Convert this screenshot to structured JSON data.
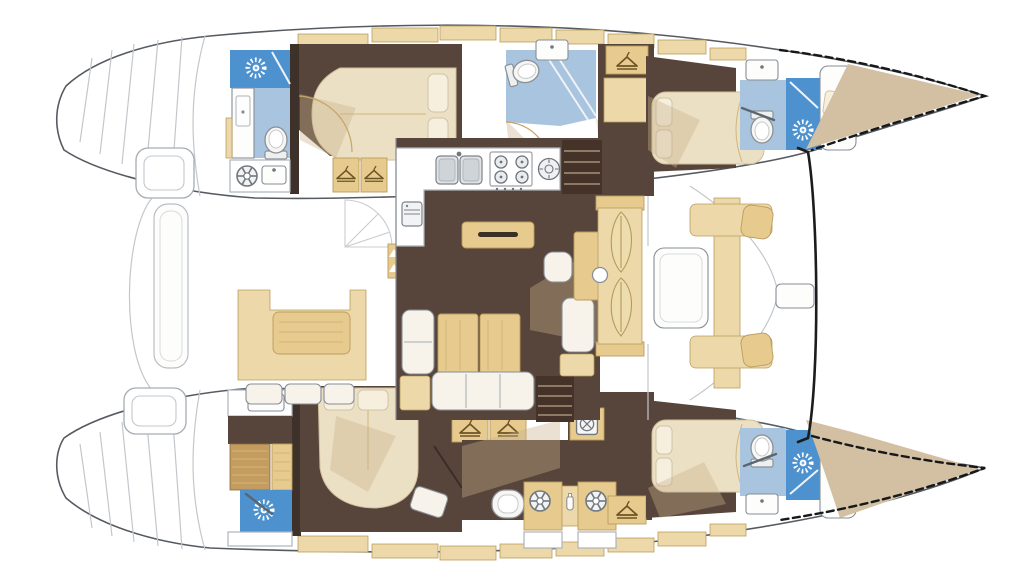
{
  "document": {
    "kind": "catamaran-yacht-interior-floor-plan",
    "view": "top-down deck plan, bow pointing right, stern at left",
    "visible_text": "none"
  },
  "palette": {
    "hull_outline": "#565b61",
    "deck_line": "#c3c7cc",
    "bold_beam": "#1b1c1e",
    "floor_brown": "#57453b",
    "floor_brown_dark": "#3e312a",
    "stairs_brown": "#45332a",
    "overlay_beige": "#c8b08c",
    "tan": "#ecd8a8",
    "tan_deep": "#e6ca8e",
    "tan_stroke": "#bb9d5e",
    "cream_bed": "#ece0c4",
    "cushion_white": "#f7f3ea",
    "bath_blue": "#a9c4de",
    "shower_blue": "#4d92cf",
    "wood_teak": "#c59c5f",
    "bow_tan": "#d3bfa2",
    "fixture": "#878e95"
  },
  "icons": {
    "shower-fan-icon": "white sunburst on blue shower floor",
    "wardrobe-hanger-icon": "clothes hanger on tan locker",
    "porthole-icon": "spoked circle",
    "washing-machine-icon": "drum circle with cross",
    "toilet-icon": "oval bowl with tank",
    "sink-icon": "basin with faucet dot",
    "stove-icon": "four burner rings",
    "double-sink-icon": "twin basins",
    "fridge-icon": "small appliance door",
    "bottle-icon": "small bottle"
  },
  "areas": {
    "aft_platform": [
      "transom steps port",
      "transom steps starboard",
      "curved swim platform",
      "helm seat port",
      "helm seat starboard",
      "transom bench"
    ],
    "aft_cockpit": [
      "u-shaped sofa",
      "cockpit table",
      "bench cushions"
    ],
    "salon": [
      "galley L counter",
      "double sink",
      "4-burner stove",
      "round burner",
      "fridge",
      "island sideboard",
      "dining table",
      "sofa",
      "side benches",
      "nav seat",
      "nav desk",
      "stairs to port hull",
      "stairs to starboard hull",
      "forward double door with knob"
    ],
    "forward_cockpit": [
      "table",
      "cross bench",
      "seat pad",
      "forward crossbeam"
    ],
    "port_hull": [
      "aft head: shower + fan, sink cabinet, toilet, utility counter with porthole and sink",
      "aft cabin: double bed, two hanger lockers",
      "mid head: toilet, sink, glass shower door",
      "hanger locker",
      "forward cabin: double bed",
      "forward head: sink, toilet, blue shower with fan",
      "bow berth with pillow",
      "tan bow tip (dashed outline)"
    ],
    "starboard_hull": [
      "aft head: sink counter, teak grate, blue shower with fan",
      "aft cabin: double bed, stool, two hanger lockers",
      "utility room: toilet, two portholes, bottle, washing machine, hanger locker",
      "forward cabin: double bed",
      "forward head: toilet, sink, blue shower with fan",
      "bow berth with pillow",
      "tan bow tip (dashed outline)"
    ]
  }
}
